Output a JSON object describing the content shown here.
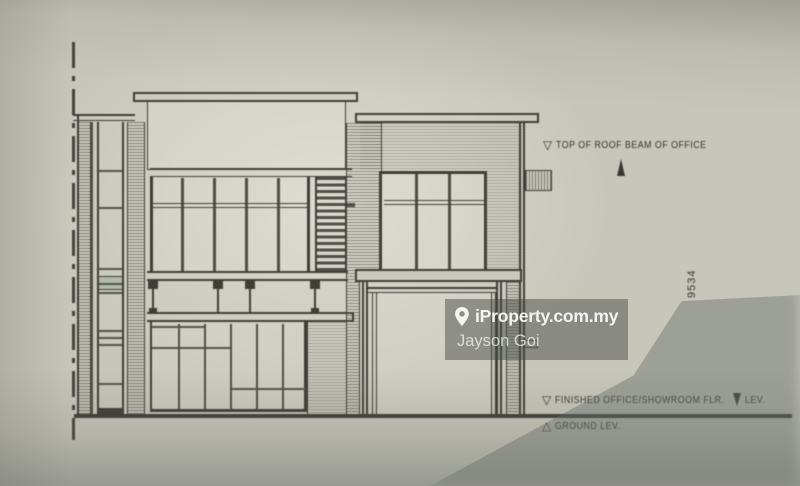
{
  "drawing": {
    "annotations": {
      "roof_level": {
        "marker": "▽",
        "label": "TOP OF ROOF BEAM OF OFFICE"
      },
      "floor_level": {
        "marker": "▽",
        "label_before": "FINISHED OFFICE/SHOWROOM FLR.",
        "label_after": "LEV."
      },
      "ground_level": {
        "marker": "△",
        "label": "GROUND LEV."
      },
      "vertical_dimension": "9534"
    }
  },
  "watermark": {
    "brand": "iProperty.com.my",
    "agent": "Jayson Goi",
    "icon": "location-pin-icon",
    "bg_color": "rgba(70,73,68,0.48)",
    "text_color": "#f3f5f2"
  },
  "colors": {
    "paper": "#c7c6ba",
    "ink": "#34342e",
    "shadow": "#6c7470"
  }
}
